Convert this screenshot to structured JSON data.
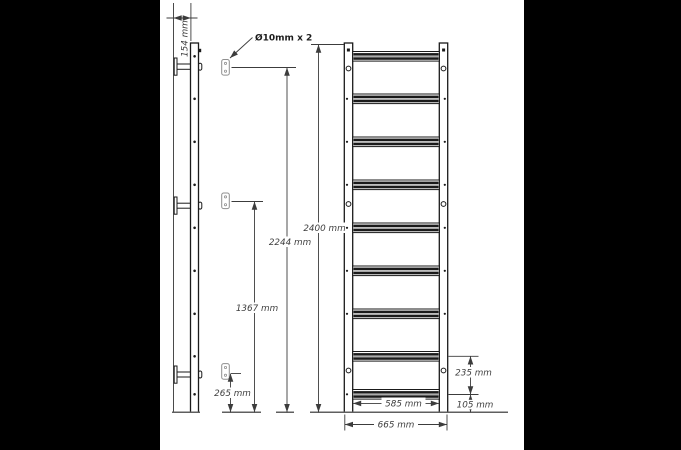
{
  "labels": {
    "depth": "154 mm",
    "hole_callout": "Ø10mm x 2",
    "height_top_anchor": "2244 mm",
    "height_total": "2400 mm",
    "height_mid_anchor": "1367 mm",
    "height_bottom_anchor": "265 mm",
    "rung_pitch_bottom": "235 mm",
    "inner_width": "585 mm",
    "bottom_clearance": "105 mm",
    "outer_width": "665 mm"
  },
  "structure": {
    "views": [
      "side view",
      "front view"
    ],
    "rung_count": 9,
    "anchor_plate_count": 3,
    "bracket_count": 3
  },
  "colors": {
    "background": "#000000",
    "paper": "#ffffff",
    "ink": "#1a1a1a",
    "dim": "#3c3c3c",
    "dimtext": "#3d3d3d",
    "plate": "#8f8f8f",
    "ground": "#5f5f5f"
  }
}
